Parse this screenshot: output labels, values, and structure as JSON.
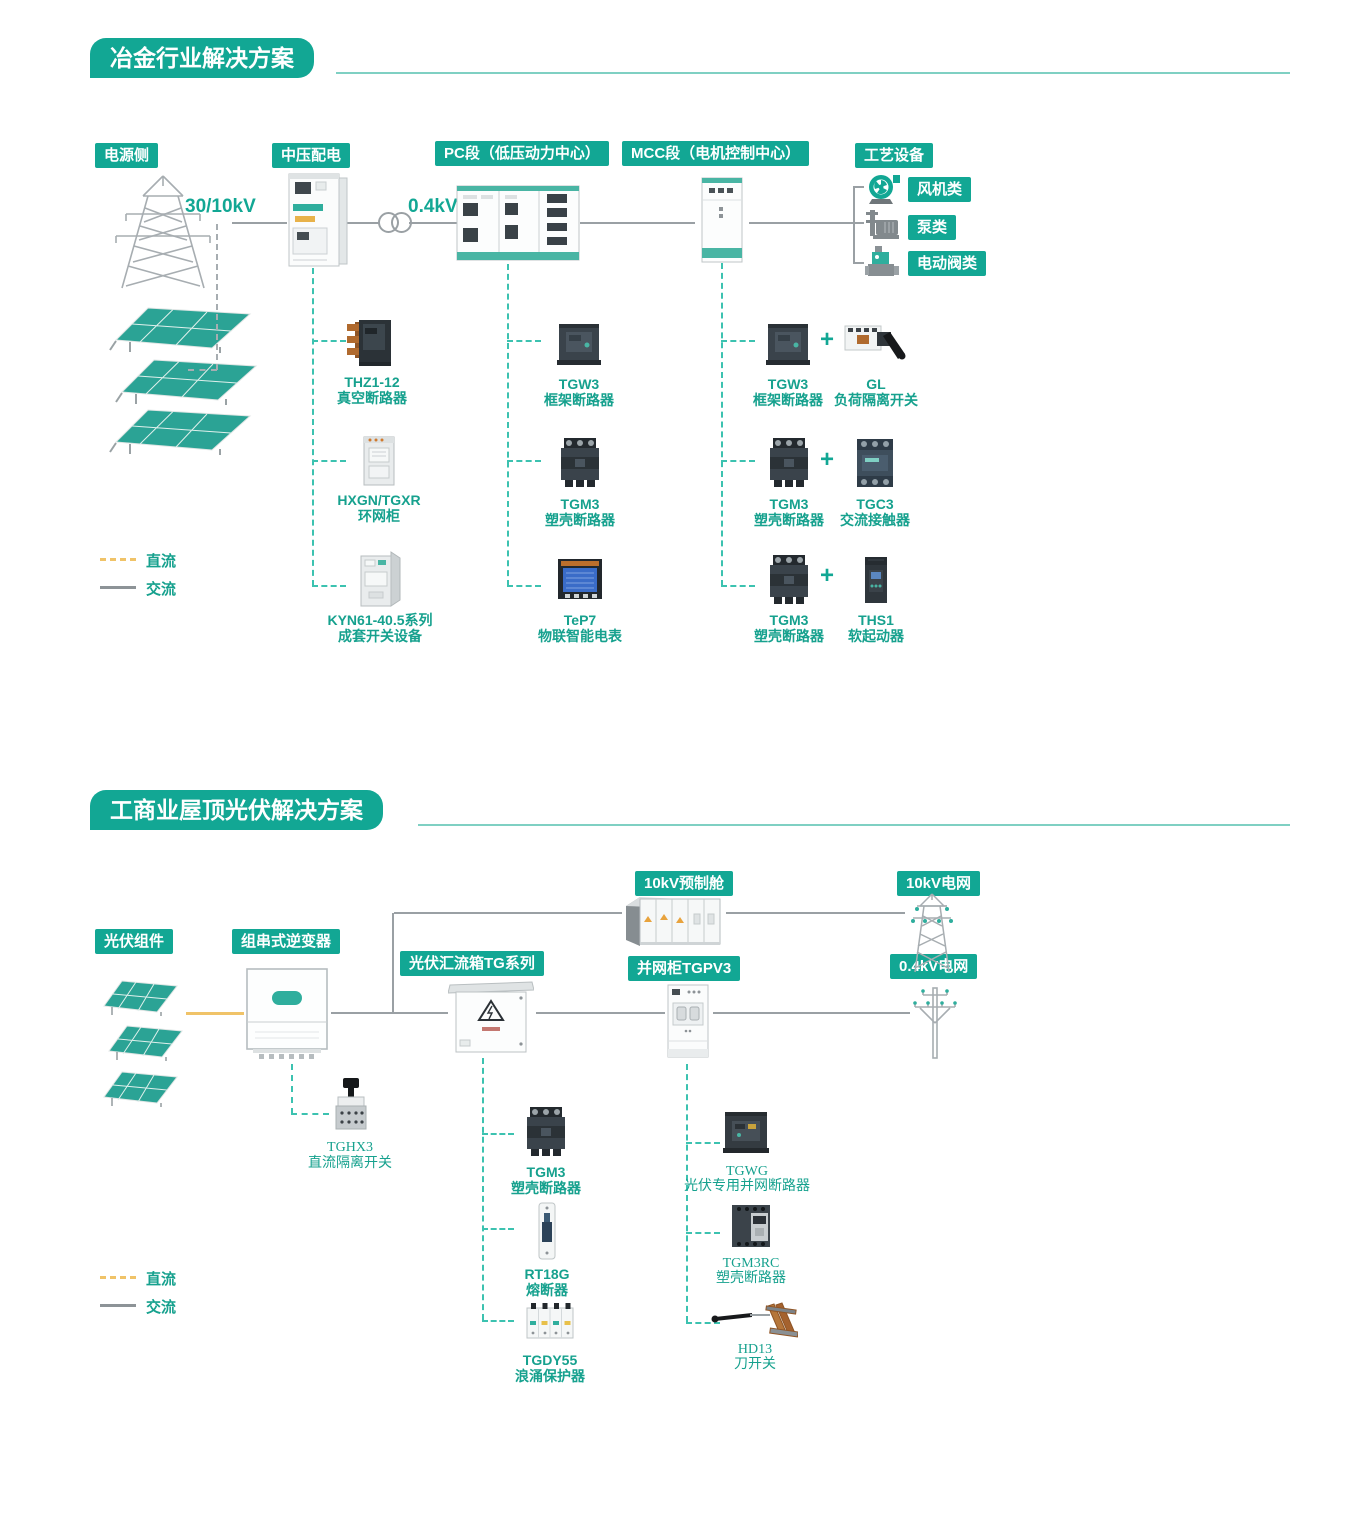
{
  "colors": {
    "brand_teal": "#12a794",
    "label_teal": "#16a18e",
    "dashed_teal": "#3cc2b0",
    "dc_yellow": "#f0c368",
    "ac_gray": "#9aa0a4"
  },
  "section1": {
    "title": "冶金行业解决方案",
    "chips": {
      "power_side": "电源侧",
      "mv": "中压配电",
      "pc": "PC段（低压动力中心）",
      "mcc": "MCC段（电机控制中心）",
      "process": "工艺设备"
    },
    "voltages": {
      "grid": "30/10kV",
      "lv": "0.4kV"
    },
    "process_types": [
      {
        "label": "风机类"
      },
      {
        "label": "泵类"
      },
      {
        "label": "电动阀类"
      }
    ],
    "mv_products": [
      {
        "model": "THZ1-12",
        "desc": "真空断路器"
      },
      {
        "model": "HXGN/TGXR",
        "desc": "环网柜"
      },
      {
        "model": "KYN61-40.5系列",
        "desc": "成套开关设备"
      }
    ],
    "pc_products": [
      {
        "model": "TGW3",
        "desc": "框架断路器"
      },
      {
        "model": "TGM3",
        "desc": "塑壳断路器"
      },
      {
        "model": "TeP7",
        "desc": "物联智能电表"
      }
    ],
    "mcc_products": [
      {
        "left": {
          "model": "TGW3",
          "desc": "框架断路器"
        },
        "plus": "+",
        "right": {
          "model": "GL",
          "desc": "负荷隔离开关"
        }
      },
      {
        "left": {
          "model": "TGM3",
          "desc": "塑壳断路器"
        },
        "plus": "+",
        "right": {
          "model": "TGC3",
          "desc": "交流接触器"
        }
      },
      {
        "left": {
          "model": "TGM3",
          "desc": "塑壳断路器"
        },
        "plus": "+",
        "right": {
          "model": "THS1",
          "desc": "软起动器"
        }
      }
    ],
    "legend": {
      "dc": "直流",
      "ac": "交流"
    }
  },
  "section2": {
    "title": "工商业屋顶光伏解决方案",
    "chips": {
      "prefab": "10kV预制舱",
      "grid10": "10kV电网",
      "pv_module": "光伏组件",
      "inverter": "组串式逆变器",
      "combiner": "光伏汇流箱TG系列",
      "grid_cabinet": "并网柜TGPV3",
      "grid04": "0.4kV电网"
    },
    "inverter_products": [
      {
        "model": "TGHX3",
        "desc": "直流隔离开关"
      }
    ],
    "combiner_products": [
      {
        "model": "TGM3",
        "desc": "塑壳断路器"
      },
      {
        "model": "RT18G",
        "desc": "熔断器"
      },
      {
        "model": "TGDY55",
        "desc": "浪涌保护器"
      }
    ],
    "grid_products": [
      {
        "model": "TGWG",
        "desc": "光伏专用并网断路器"
      },
      {
        "model": "TGM3RC",
        "desc": "塑壳断路器"
      },
      {
        "model": "HD13",
        "desc": "刀开关"
      }
    ],
    "legend": {
      "dc": "直流",
      "ac": "交流"
    }
  }
}
